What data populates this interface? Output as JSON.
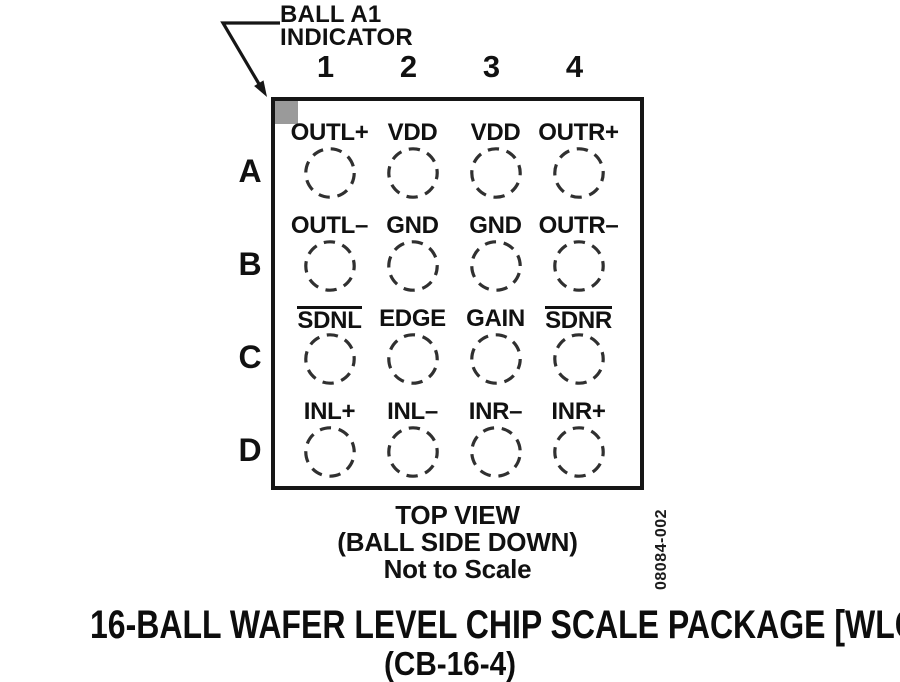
{
  "callout": {
    "line1": "BALL A1",
    "line2": "INDICATOR"
  },
  "column_headers": [
    "1",
    "2",
    "3",
    "4"
  ],
  "grid": {
    "rows": [
      {
        "letter": "A",
        "cells": [
          "OUTL+",
          "VDD",
          "VDD",
          "OUTR+"
        ]
      },
      {
        "letter": "B",
        "cells": [
          "OUTL–",
          "GND",
          "GND",
          "OUTR–"
        ]
      },
      {
        "letter": "C",
        "cells": [
          "SDNL",
          "EDGE",
          "GAIN",
          "SDNR"
        ]
      },
      {
        "letter": "D",
        "cells": [
          "INL+",
          "INL–",
          "INR–",
          "INR+"
        ]
      }
    ],
    "overlined_pins": [
      "SDNL",
      "SDNR"
    ]
  },
  "view_note": {
    "line1": "TOP VIEW",
    "line2": "(BALL SIDE DOWN)",
    "line3": "Not to Scale"
  },
  "figure_number": "08084-002",
  "caption": {
    "line1": "16-BALL WAFER LEVEL CHIP SCALE PACKAGE [WLCSP]",
    "line2": "(CB-16-4)"
  },
  "colors": {
    "ink": "#111111",
    "ball_a1_indicator_gray": "#9a9a9a"
  }
}
